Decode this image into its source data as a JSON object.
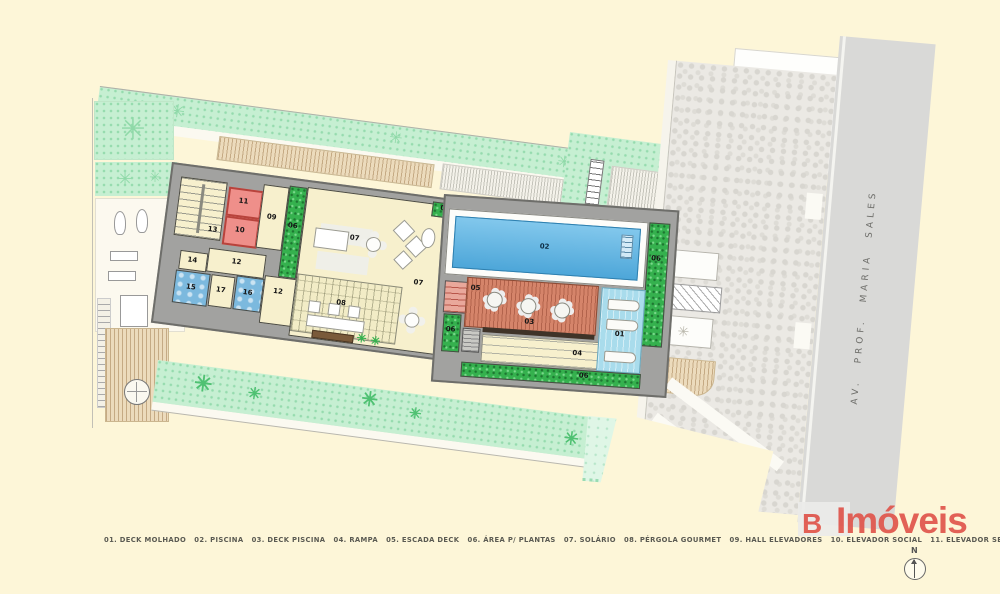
{
  "colors": {
    "background": "#fdf6d8",
    "pool_blue": "#58b5e6",
    "wet_deck_blue": "#a9dcec",
    "deck_wood": "#d5846a",
    "elevator_red": "#ef8f8a",
    "wc_blue": "#7cb9de",
    "plant_green": "#35b14e",
    "mint_landscape": "#c6efd2",
    "road_gray": "#d9d9d7",
    "wall_gray": "#a2a2a0",
    "logo_red": "#e0554c"
  },
  "plan": {
    "labels": {
      "n01": "01",
      "n02": "02",
      "n03": "03",
      "n04": "04",
      "n05": "05",
      "n06": "06",
      "n07": "07",
      "n08": "08",
      "n09": "09",
      "n10": "10",
      "n11": "11",
      "n12": "12",
      "n13": "13",
      "n14": "14",
      "n15": "15",
      "n16": "16",
      "n17": "17"
    }
  },
  "legend": {
    "line": "01. DECK MOLHADO   02. PISCINA   03. DECK PISCINA   04. RAMPA   05. ESCADA DECK   06. ÁREA P/ PLANTAS   07. SOLÁRIO   08. PÉRGOLA GOURMET   09. HALL ELEVADORES   10. ELEVADOR SOCIAL   11. ELEVADOR SERVIÇO   12. CIRCULAÇÃO   13. ESCADA   14. DEPÓSITO   15. WC (CL.) MASCULINO   16. WC (CL.) FEMININO   17. HALL WC'S",
    "items": [
      {
        "num": "01",
        "label": "DECK MOLHADO"
      },
      {
        "num": "02",
        "label": "PISCINA"
      },
      {
        "num": "03",
        "label": "DECK PISCINA"
      },
      {
        "num": "04",
        "label": "RAMPA"
      },
      {
        "num": "05",
        "label": "ESCADA DECK"
      },
      {
        "num": "06",
        "label": "ÁREA P/ PLANTAS"
      },
      {
        "num": "07",
        "label": "SOLÁRIO"
      },
      {
        "num": "08",
        "label": "PÉRGOLA GOURMET"
      },
      {
        "num": "09",
        "label": "HALL ELEVADORES"
      },
      {
        "num": "10",
        "label": "ELEVADOR SOCIAL"
      },
      {
        "num": "11",
        "label": "ELEVADOR SERVIÇO"
      },
      {
        "num": "12",
        "label": "CIRCULAÇÃO"
      },
      {
        "num": "13",
        "label": "ESCADA"
      },
      {
        "num": "14",
        "label": "DEPÓSITO"
      },
      {
        "num": "15",
        "label": "WC (CL.) MASCULINO"
      },
      {
        "num": "16",
        "label": "WC (CL.) FEMININO"
      },
      {
        "num": "17",
        "label": "HALL WC'S"
      }
    ]
  },
  "street": {
    "name": "AV.  PROF.  MARIA  SALES"
  },
  "logo": {
    "mark": "B",
    "name": "Imóveis"
  },
  "compass": {
    "label": "N"
  }
}
